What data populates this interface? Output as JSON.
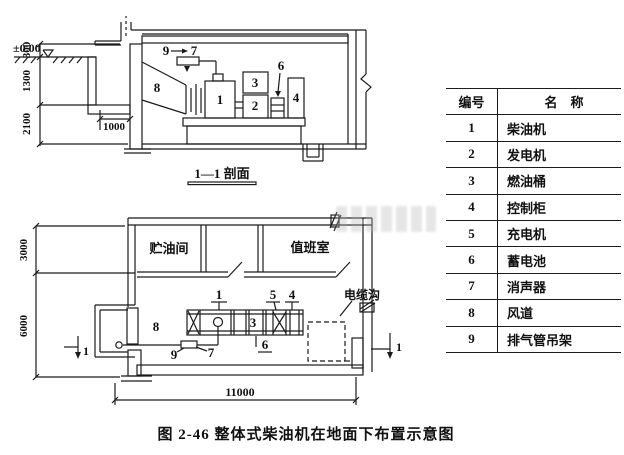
{
  "figure": {
    "caption": "图 2-46  整体式柴油机在地面下布置示意图"
  },
  "section_view": {
    "title": "1—1 剖面",
    "level_label": "±0.00",
    "dim_300": "300",
    "dim_1300": "1300",
    "dim_2100": "2100",
    "dim_1000": "1000"
  },
  "plan_view": {
    "room_oil_storage": "贮油间",
    "room_duty": "值班室",
    "cable_trench_label": "电缆沟",
    "dim_3000": "3000",
    "dim_6000": "6000",
    "dim_11000": "11000",
    "section_cut_label": "1"
  },
  "parts": {
    "p1": "1",
    "p2": "2",
    "p3": "3",
    "p4": "4",
    "p5": "5",
    "p6": "6",
    "p7": "7",
    "p8": "8",
    "p9": "9"
  },
  "legend_table": {
    "headers": {
      "no": "编号",
      "name": "名　称"
    },
    "rows": [
      {
        "no": "1",
        "name": "柴油机"
      },
      {
        "no": "2",
        "name": "发电机"
      },
      {
        "no": "3",
        "name": "燃油桶"
      },
      {
        "no": "4",
        "name": "控制柜"
      },
      {
        "no": "5",
        "name": "充电机"
      },
      {
        "no": "6",
        "name": "蓄电池"
      },
      {
        "no": "7",
        "name": "消声器"
      },
      {
        "no": "8",
        "name": "风道"
      },
      {
        "no": "9",
        "name": "排气管吊架"
      }
    ]
  },
  "colors": {
    "line": "#1b1b1b",
    "paper": "#ffffff"
  }
}
